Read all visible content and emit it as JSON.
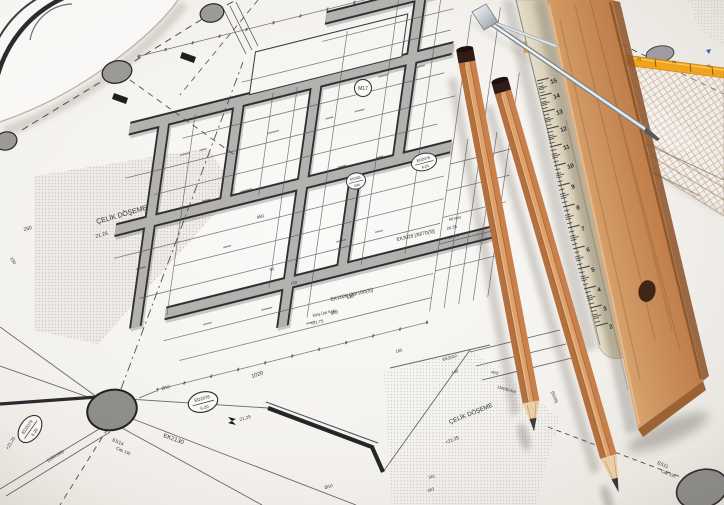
{
  "colors": {
    "paper": "#f6f4f0",
    "ink": "#2f2e33",
    "wall_gray": "#b4b2af",
    "pencil_wood_light": "#e0a169",
    "pencil_wood_dark": "#b56f3e",
    "pencil_cap": "#2e1b14",
    "wood_ruler": "#c98e5f",
    "cream_ruler": "#eee7d6",
    "set_square_stripe": "#f2a41d",
    "metal": "#cfd3d6",
    "column_bubble": "#8e8d8a"
  },
  "blueprint": {
    "bubble_label": "M17",
    "labels": [
      {
        "t": "ÇELİK DÖŞEME",
        "x": 97,
        "y": 224,
        "r": -16,
        "s": 7
      },
      {
        "t": "21.25",
        "x": 96,
        "y": 238,
        "r": -16,
        "s": 5
      },
      {
        "t": "250",
        "x": 24,
        "y": 231,
        "r": -14,
        "s": 5
      },
      {
        "t": "150",
        "x": 10,
        "y": 258,
        "r": 62,
        "s": 4.5
      },
      {
        "t": "EK3028 [30/70(3)]",
        "x": 397,
        "y": 241,
        "r": -13,
        "s": 4.8
      },
      {
        "t": "A8 kolu",
        "x": 449,
        "y": 221,
        "r": -13,
        "s": 3.8
      },
      {
        "t": "20.35",
        "x": 447,
        "y": 230,
        "r": -13,
        "s": 4.2
      },
      {
        "t": "20.75",
        "x": 449,
        "y": 239,
        "r": -13,
        "s": 4.2
      },
      {
        "t": "EK2026 [30/100(3)]",
        "x": 331,
        "y": 301,
        "r": -13,
        "s": 5
      },
      {
        "t": "Kiriş Üst Kotu",
        "x": 313,
        "y": 317,
        "r": -13,
        "s": 4
      },
      {
        "t": "+21.75",
        "x": 311,
        "y": 325,
        "r": -13,
        "s": 4.2
      },
      {
        "t": "450",
        "x": 257,
        "y": 219,
        "r": -14,
        "s": 4.5
      },
      {
        "t": "530",
        "x": 347,
        "y": 299,
        "r": -14,
        "s": 4.5
      },
      {
        "t": "360",
        "x": 331,
        "y": 315,
        "r": -14,
        "s": 4.5
      },
      {
        "t": "150",
        "x": 291,
        "y": 285,
        "r": -14,
        "s": 4
      },
      {
        "t": "90",
        "x": 270,
        "y": 271,
        "r": -14,
        "s": 4
      },
      {
        "t": "1020",
        "x": 252,
        "y": 378,
        "r": -18,
        "s": 5.5
      },
      {
        "t": "EK2130",
        "x": 163,
        "y": 437,
        "r": 20,
        "s": 6
      },
      {
        "t": "Ø10",
        "x": 162,
        "y": 390,
        "r": -15,
        "s": 4.5
      },
      {
        "t": "21.25",
        "x": 240,
        "y": 421,
        "r": -15,
        "s": 4.6
      },
      {
        "t": "ES14",
        "x": 112,
        "y": 441,
        "r": 24,
        "s": 4.8
      },
      {
        "t": "Çap 135",
        "x": 116,
        "y": 449,
        "r": 24,
        "s": 4
      },
      {
        "t": "+21.25",
        "x": 8,
        "y": 450,
        "r": -58,
        "s": 4.6
      },
      {
        "t": "(180/180)",
        "x": 48,
        "y": 462,
        "r": -31,
        "s": 4.4
      },
      {
        "t": "EK2022",
        "x": 443,
        "y": 361,
        "r": -16,
        "s": 4.2
      },
      {
        "t": "180",
        "x": 396,
        "y": 353,
        "r": -16,
        "s": 4
      },
      {
        "t": "140",
        "x": 452,
        "y": 374,
        "r": -16,
        "s": 4
      },
      {
        "t": "ø10",
        "x": 491,
        "y": 373,
        "r": 14,
        "s": 4.2
      },
      {
        "t": "150/35-50]",
        "x": 497,
        "y": 388,
        "r": 16,
        "s": 4
      },
      {
        "t": "[50/35]",
        "x": 551,
        "y": 392,
        "r": 68,
        "s": 4
      },
      {
        "t": "ÇELİK DÖŞEME",
        "x": 450,
        "y": 424,
        "r": -22,
        "s": 6.2
      },
      {
        "t": "+21.25",
        "x": 446,
        "y": 444,
        "r": -22,
        "s": 4.6
      },
      {
        "t": "261",
        "x": 429,
        "y": 479,
        "r": -18,
        "s": 4
      },
      {
        "t": "263",
        "x": 428,
        "y": 492,
        "r": -18,
        "s": 4
      },
      {
        "t": "Ø10",
        "x": 325,
        "y": 489,
        "r": -15,
        "s": 4.4
      },
      {
        "t": "ES11",
        "x": 657,
        "y": 464,
        "r": 22,
        "s": 4.8
      },
      {
        "t": "Çap 135",
        "x": 661,
        "y": 472,
        "r": 22,
        "s": 4
      }
    ],
    "stamps": [
      {
        "l1": "ED2078",
        "l2": "6-20"
      },
      {
        "l1": "ED2079",
        "l2": "6-20"
      },
      {
        "l1": "ED2078",
        "l2": "6-20"
      },
      {
        "l1": "EK026",
        "l2": "645"
      }
    ]
  },
  "white_ruler": {
    "numbers": [
      {
        "n": "15",
        "x": 551,
        "y": 84
      },
      {
        "n": "14",
        "x": 554,
        "y": 99
      },
      {
        "n": "13",
        "x": 557,
        "y": 115
      },
      {
        "n": "12",
        "x": 561,
        "y": 132
      },
      {
        "n": "11",
        "x": 564,
        "y": 150
      },
      {
        "n": "10",
        "x": 568,
        "y": 169
      },
      {
        "n": "9",
        "x": 572,
        "y": 189
      },
      {
        "n": "8",
        "x": 577,
        "y": 210
      },
      {
        "n": "7",
        "x": 582,
        "y": 231
      },
      {
        "n": "6",
        "x": 587,
        "y": 252
      },
      {
        "n": "5",
        "x": 592,
        "y": 272
      },
      {
        "n": "4",
        "x": 598,
        "y": 292
      },
      {
        "n": "3",
        "x": 604,
        "y": 311
      },
      {
        "n": "2",
        "x": 610,
        "y": 329
      }
    ]
  },
  "set_square": {
    "stripe_labels": [
      {
        "t": "05",
        "x": 637,
        "y": 60
      },
      {
        "t": "06",
        "x": 672,
        "y": 63
      },
      {
        "t": "05",
        "x": 707,
        "y": 67
      }
    ]
  }
}
